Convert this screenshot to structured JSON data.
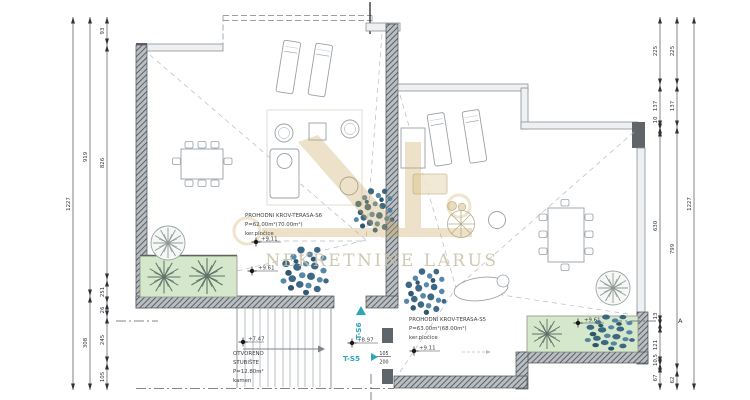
{
  "watermark": {
    "text": "NEKRETNINE LARUS"
  },
  "units": {
    "s6": {
      "name": "PROHODNI KROV-TERASA-S6",
      "area": "P=62.00m²(70.00m²)",
      "finish": "ker.pločice",
      "elevation": "+9.11"
    },
    "s5": {
      "name": "PROHODNI KROV-TERASA-S5",
      "area": "P=63.00m²(68.00m²)",
      "finish": "ker.pločice",
      "elevation": "+9.11"
    }
  },
  "stairs": {
    "label_line1": "OTVORENO",
    "label_line2": "STUBIŠTE",
    "area": "P=12.80m²",
    "finish": "kamen",
    "elevation": "+7.47"
  },
  "landing": {
    "t_s6": "T-S6",
    "t_s5": "T-S5",
    "elevation": "+8.97",
    "step_rise": "105",
    "step_run": "200"
  },
  "planters": {
    "left_elevation": "+9.61",
    "right_elevation": "+9.61"
  },
  "section": {
    "label": "A"
  },
  "dimensions": {
    "left_outer": [
      "1227"
    ],
    "left_middle": [
      "919",
      "308"
    ],
    "left_inner": [
      "93",
      "826",
      "251",
      "26",
      "245",
      "105"
    ],
    "right_inner": [
      "225",
      "137",
      "10",
      "630",
      "13",
      "121",
      "10,5",
      "67"
    ],
    "right_middle": [
      "225",
      "137",
      "799",
      "62"
    ],
    "right_outer": [
      "1227"
    ]
  },
  "colors": {
    "plan_line": "#8a9097",
    "wall_dark": "#4a4f54",
    "planter_green": "#d6e8cb",
    "shrub_blue": "#2e5d7c",
    "accent_teal": "#2aa8b8",
    "watermark_gold": "#c9a85a"
  }
}
